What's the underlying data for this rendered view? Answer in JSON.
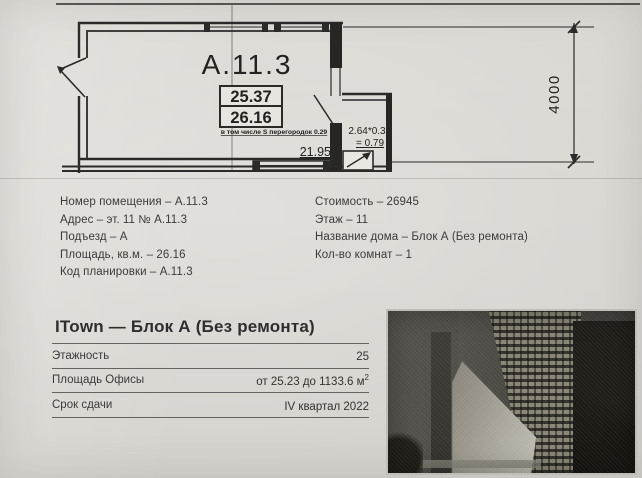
{
  "plan": {
    "unit_title": "А.11.3",
    "area_upper": "25.37",
    "area_lower": "26.16",
    "partitions_note": "в том числе S перегородок 0.29",
    "width_dim": "21.95",
    "shaft_calc_top": "2.64*0.3",
    "shaft_calc_bottom": "= 0.79",
    "height_dim": "4000"
  },
  "details_left": [
    "Номер помещения – А.11.3",
    "Адрес – эт. 11 № А.11.3",
    "Подъезд – А",
    "Площадь, кв.м. – 26.16",
    "Код планировки – А.11.3"
  ],
  "details_right": [
    "Стоимость – 26945",
    "Этаж – 11",
    "Название дома – Блок А (Без ремонта)",
    "Кол-во комнат – 1"
  ],
  "summary": {
    "title": "ITown — Блок А (Без ремонта)",
    "rows": [
      {
        "label": "Этажность",
        "value": "25",
        "sup": ""
      },
      {
        "label": "Площадь Офисы",
        "value": "от 25.23 до 1133.6 м",
        "sup": "2"
      },
      {
        "label": "Срок сдачи",
        "value": "IV квартал 2022",
        "sup": ""
      }
    ]
  },
  "colors": {
    "ink": "#1f1f1f",
    "paper": "#d9d7d2",
    "text": "#3b3b3b"
  }
}
